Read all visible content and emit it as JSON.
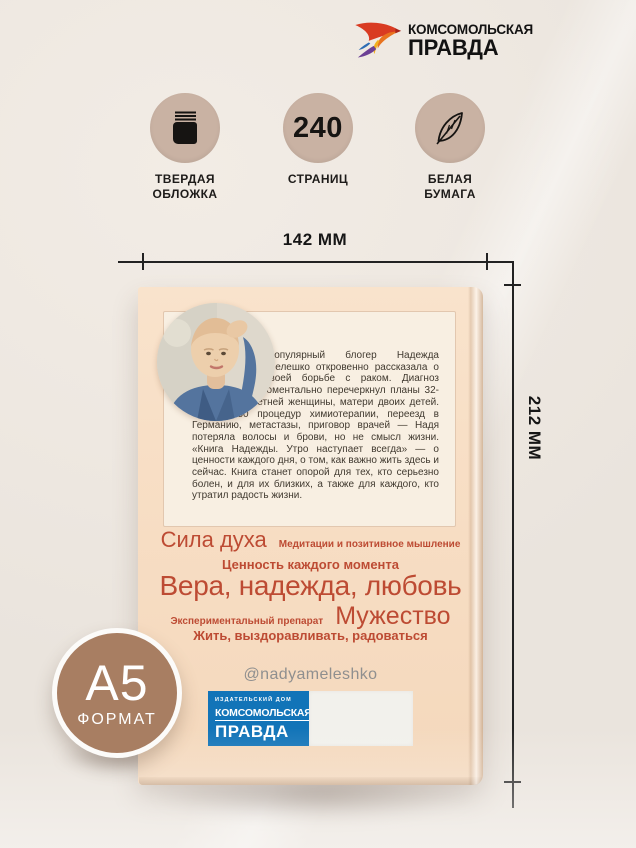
{
  "brand": {
    "line1": "КОМСОМОЛЬСКАЯ",
    "line2": "ПРАВДА",
    "bird_icon": "kp-bird-icon"
  },
  "features": [
    {
      "icon": "book-icon",
      "label": "ТВЕРДАЯ ОБЛОЖКА"
    },
    {
      "icon": "number-badge",
      "value": "240",
      "label": "СТРАНИЦ"
    },
    {
      "icon": "feather-icon",
      "label": "БЕЛАЯ БУМАГА"
    }
  ],
  "dimensions": {
    "width_label": "142 ММ",
    "height_label": "212 ММ"
  },
  "book": {
    "bio": "Популярный блогер Надежда Мелешко откровенно рассказала о своей борьбе с раком. Диагноз моментально перечеркнул планы 32-летней женщины, матери двоих детей. 50 процедур химиотерапии, переезд в Германию, метастазы, приговор врачей — Надя потеряла волосы и брови, но не смысл жизни. «Книга Надежды. Утро наступает всегда» — о ценности каждого дня, о том, как важно жить здесь и сейчас. Книга станет опорой для тех, кто серьезно болен, и для их близких, а также для каждого, кто утратил радость жизни.",
    "keywords": {
      "line1_big": "Сила духа",
      "line1_small": "Медитации и позитивное мышление",
      "line2": "Ценность каждого момента",
      "line3": "Вера, надежда, любовь",
      "line4_small": "Экспериментальный препарат",
      "line4_big": "Мужество",
      "line5": "Жить, выздоравливать, радоваться"
    },
    "handle": "@nadyameleshko",
    "publisher": {
      "line1": "ИЗДАТЕЛЬСКИЙ ДОМ",
      "line2": "КОМСОМОЛЬСКАЯ",
      "line3": "ПРАВДА"
    }
  },
  "format_badge": {
    "size": "А5",
    "label": "ФОРМАТ"
  },
  "colors": {
    "page_bg": "#ece6df",
    "cover_peach": "#f8dfc6",
    "panel_cream": "#f8efe2",
    "keyword_terracotta": "#bd4b33",
    "badge_brown": "#a87e62",
    "icon_circle_tan": "#c9b2a3",
    "publisher_blue": "#1274b8",
    "handle_gray": "#8f8f8f"
  }
}
